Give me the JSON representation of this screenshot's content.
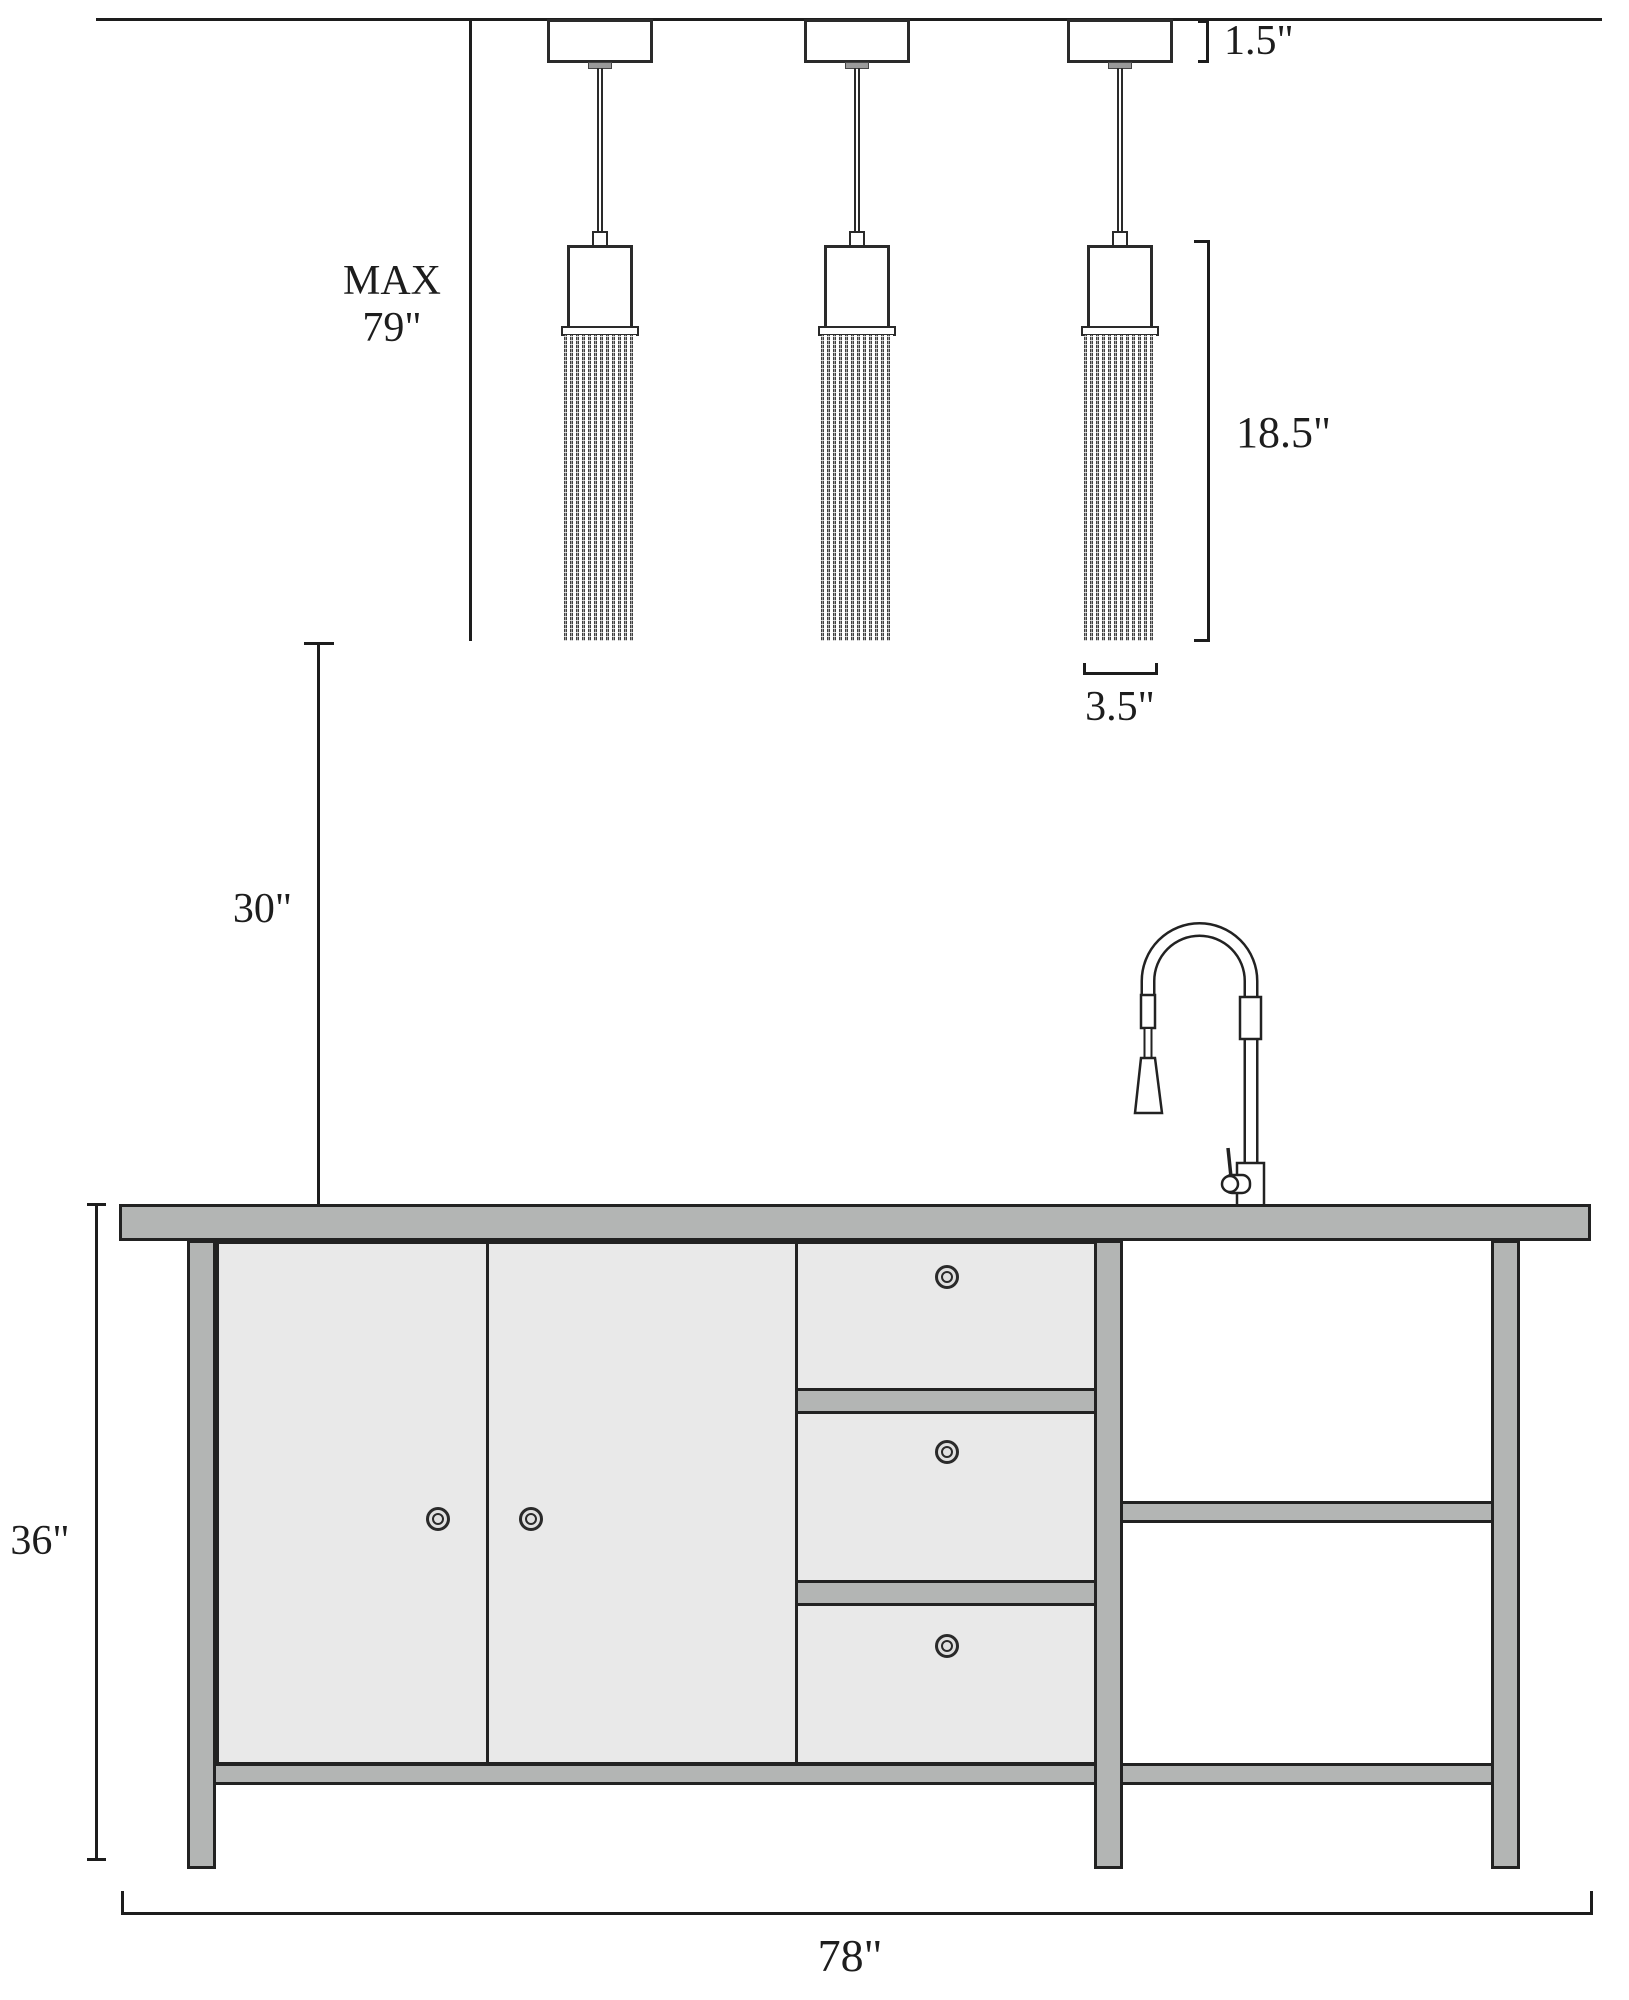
{
  "drawing": {
    "title": "Kitchen island with three pendant lights — dimensioned elevation",
    "units": "inches"
  },
  "dimensions": {
    "canopy_height": "1.5\"",
    "max_drop_line1": "MAX",
    "max_drop_line2": "79\"",
    "shade_height": "18.5\"",
    "shade_width": "3.5\"",
    "pendant_to_counter": "30\"",
    "island_height": "36\"",
    "island_width": "78\""
  },
  "objects": {
    "pendant_count": 3,
    "cabinet_door_count": 2,
    "drawer_count": 3
  },
  "colors": {
    "line": "#1d1d1d",
    "cabinet_fill": "#e9e9e9",
    "frame_fill": "#b3b5b4",
    "background": "#ffffff"
  }
}
